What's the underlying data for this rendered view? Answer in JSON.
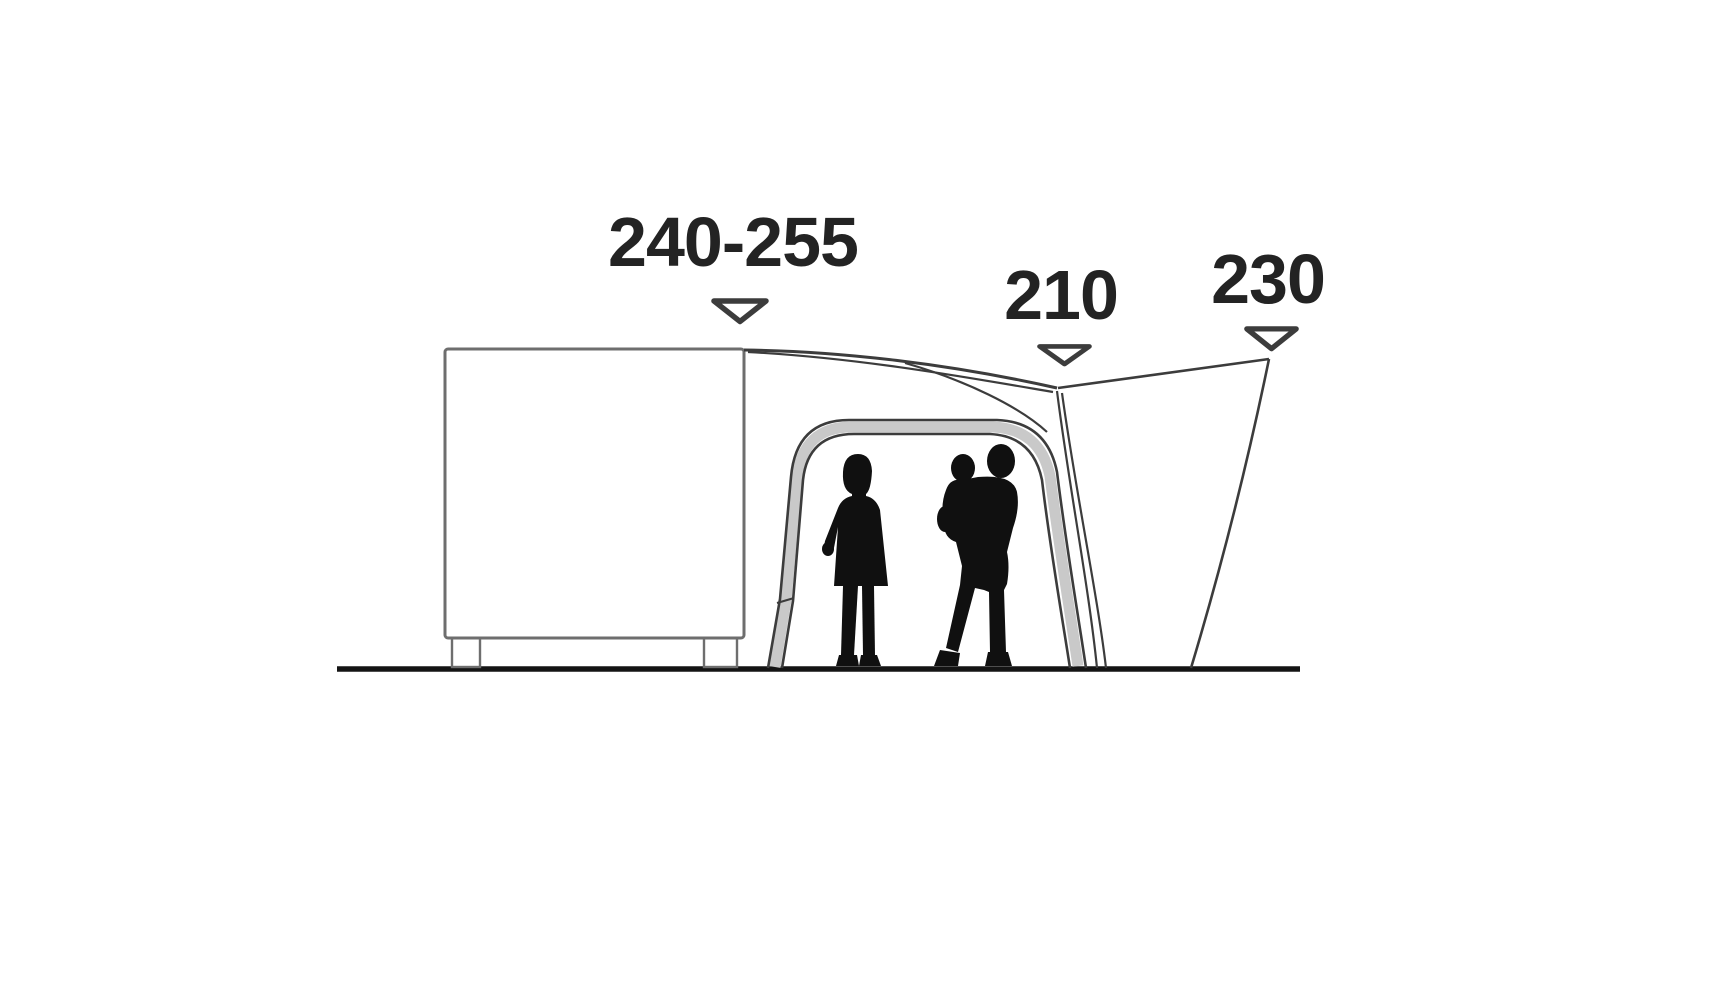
{
  "diagram": {
    "description_labels": {
      "attachment_height": "240-255",
      "door_height": "210",
      "peak_height": "230"
    }
  },
  "labels": {
    "attachment_height": "240-255",
    "door_height": "210",
    "peak_height": "230"
  },
  "colors": {
    "background": "#ffffff",
    "text": "#232323",
    "line": "#3c3c3c",
    "vehicle_line": "#6e6e6e",
    "ground": "#141414",
    "silhouette": "#101010",
    "door_frame_fill": "#c9c9c9"
  }
}
